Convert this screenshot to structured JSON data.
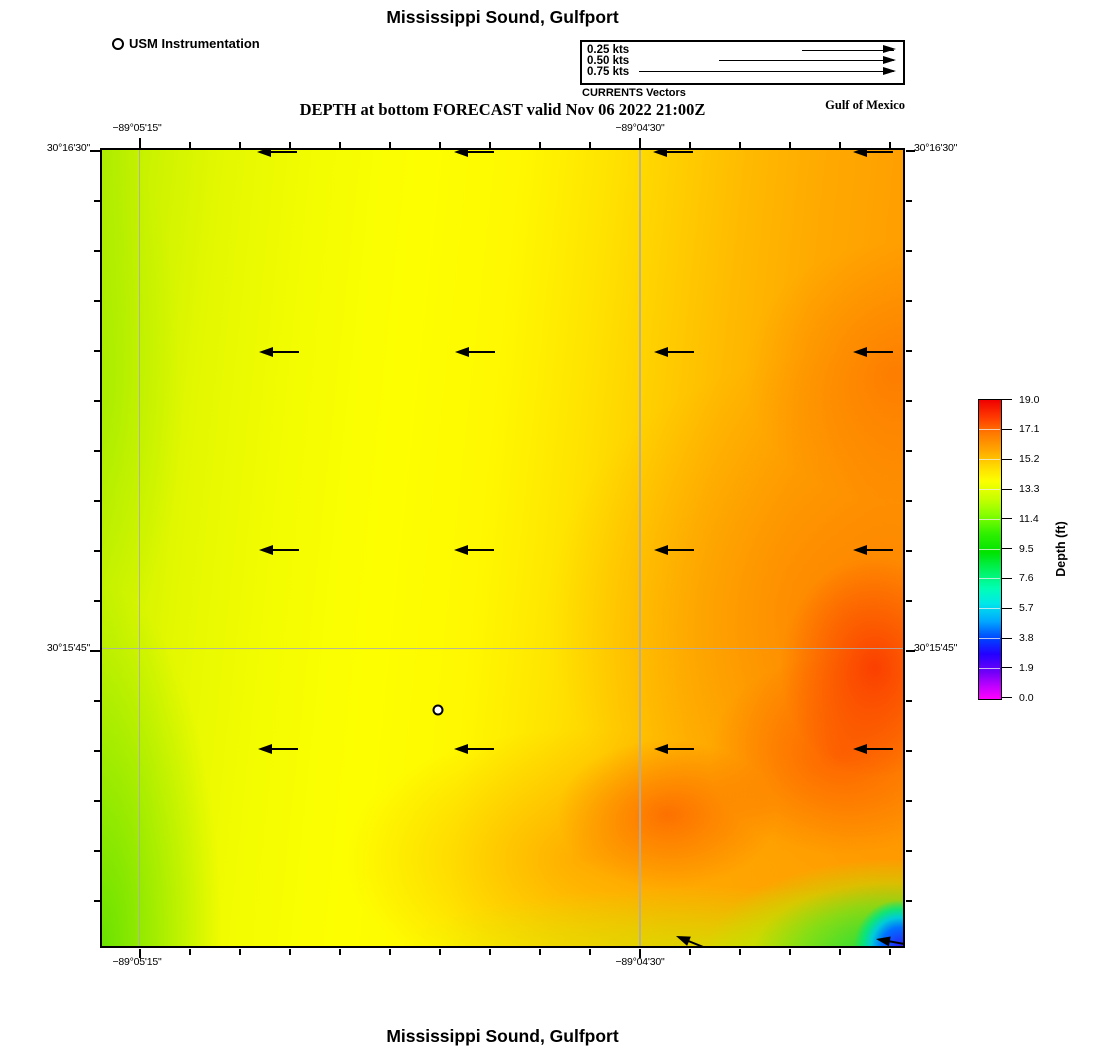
{
  "page": {
    "title_top": "Mississippi Sound, Gulfport",
    "title_bottom": "Mississippi Sound, Gulfport",
    "forecast_line": "DEPTH at bottom FORECAST valid Nov 06 2022 21:00Z",
    "region_label": "Gulf of Mexico"
  },
  "station_legend": {
    "label": "USM Instrumentation"
  },
  "vector_legend": {
    "caption": "CURRENTS Vectors",
    "items": [
      {
        "label": "0.25 kts",
        "arrow_px": 92
      },
      {
        "label": "0.50 kts",
        "arrow_px": 175
      },
      {
        "label": "0.75 kts",
        "arrow_px": 255
      }
    ]
  },
  "axes": {
    "lon_left": "−89°05'15\"",
    "lon_right": "−89°04'30\"",
    "lat_top": "30°16'30\"",
    "lat_mid": "30°15'45\""
  },
  "colorbar": {
    "title": "Depth (ft)",
    "ticks": [
      "19.0",
      "17.1",
      "15.2",
      "13.3",
      "11.4",
      "9.5",
      "7.6",
      "5.7",
      "3.8",
      "1.9",
      "0.0"
    ]
  },
  "map": {
    "gridlines": {
      "v_pct": [
        4.6,
        67.1
      ],
      "h_pct": [
        62.5
      ]
    },
    "station": {
      "x_pct": 41.9,
      "y_pct": 70.4
    },
    "vectors": [
      {
        "x": 19.3,
        "y": 0.25,
        "len": 40,
        "angle": 0
      },
      {
        "x": 44.0,
        "y": 0.25,
        "len": 40,
        "angle": 0
      },
      {
        "x": 68.8,
        "y": 0.25,
        "len": 40,
        "angle": 0
      },
      {
        "x": 93.7,
        "y": 0.25,
        "len": 40,
        "angle": 0
      },
      {
        "x": 19.6,
        "y": 25.4,
        "len": 40,
        "angle": 0
      },
      {
        "x": 44.1,
        "y": 25.4,
        "len": 40,
        "angle": 0
      },
      {
        "x": 68.9,
        "y": 25.4,
        "len": 40,
        "angle": 0
      },
      {
        "x": 93.8,
        "y": 25.4,
        "len": 40,
        "angle": 0
      },
      {
        "x": 19.6,
        "y": 50.3,
        "len": 40,
        "angle": 0
      },
      {
        "x": 44.0,
        "y": 50.3,
        "len": 40,
        "angle": 0
      },
      {
        "x": 68.9,
        "y": 50.3,
        "len": 40,
        "angle": 0
      },
      {
        "x": 93.8,
        "y": 50.3,
        "len": 40,
        "angle": 0
      },
      {
        "x": 19.5,
        "y": 75.3,
        "len": 40,
        "angle": 0
      },
      {
        "x": 43.9,
        "y": 75.3,
        "len": 40,
        "angle": 0
      },
      {
        "x": 68.9,
        "y": 75.3,
        "len": 40,
        "angle": 0
      },
      {
        "x": 93.8,
        "y": 75.3,
        "len": 40,
        "angle": 0
      },
      {
        "x": 71.7,
        "y": 98.7,
        "len": 36,
        "angle": 22
      },
      {
        "x": 96.6,
        "y": 99.1,
        "len": 32,
        "angle": 10
      }
    ]
  },
  "chart_data": {
    "type": "heatmap",
    "title": "Mississippi Sound, Gulfport",
    "subtitle": "DEPTH at bottom FORECAST valid Nov 06 2022 21:00Z",
    "colorbar_label": "Depth (ft)",
    "colorbar_ticks": [
      19.0,
      17.1,
      15.2,
      13.3,
      11.4,
      9.5,
      7.6,
      5.7,
      3.8,
      1.9,
      0.0
    ],
    "value_range_ft": [
      0.0,
      19.0
    ],
    "x_axis": {
      "type": "longitude",
      "tick_labels": [
        "−89°05'15\"",
        "−89°04'30\""
      ]
    },
    "y_axis": {
      "type": "latitude",
      "tick_labels": [
        "30°16'30\"",
        "30°15'45\""
      ]
    },
    "grid": true,
    "legend_position": "right",
    "field_estimates": [
      {
        "area": "west band near −89°05'15\"",
        "approx_depth_ft": 13.5,
        "color": "yellow-green"
      },
      {
        "area": "center",
        "approx_depth_ft": 15.0,
        "color": "yellow"
      },
      {
        "area": "east half",
        "approx_depth_ft": 17.0,
        "color": "orange"
      },
      {
        "area": "east red patches (~30°15'45\" and south)",
        "approx_depth_ft": 18.3,
        "color": "red-orange"
      },
      {
        "area": "southeast corner pocket",
        "approx_depth_ft": 3.0,
        "color": "green-cyan-blue"
      },
      {
        "area": "southwest/west edge strip",
        "approx_depth_ft": 12.0,
        "color": "green"
      }
    ],
    "current_vectors": {
      "direction": "westward (arrows point left)",
      "legend_speeds_kts": [
        0.25,
        0.5,
        0.75
      ],
      "layout": "4 columns × 4 rows, plus 2 angled arrows along the south edge"
    },
    "station_marker": {
      "name": "USM Instrumentation",
      "symbol": "white circle with black outline, south-center of map"
    }
  }
}
